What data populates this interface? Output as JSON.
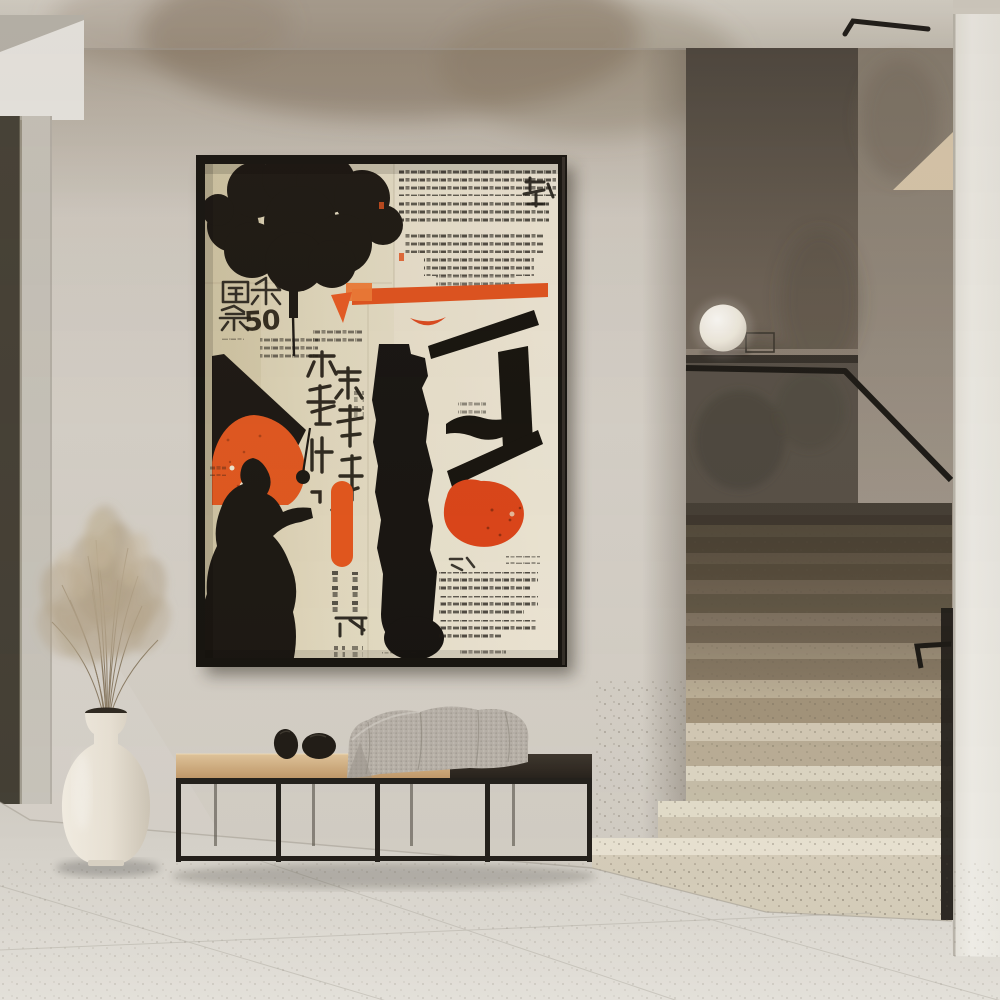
{
  "poster": {
    "number_label": "50"
  },
  "colors": {
    "ink": "#1b1712",
    "paper": "#e3dac0",
    "paper_dark": "#d3c7a5",
    "paper_light": "#ece5d3",
    "orange": "#e2521d",
    "orange_bright": "#ef7a35",
    "frame": "#15130f",
    "wall": "#d5d0c8",
    "wall_stain": "#7d6c5a",
    "ceiling": "#cbc5bb",
    "bulkhead": "#ebe9e4",
    "door_frame": "#443f35",
    "door_glass": "#c8c4bb",
    "stair_wall": "#5f574d",
    "stair_return_wall": "#978c7f",
    "step_lit": "#e2dccf",
    "step_shadow": "#7b6e5d",
    "handrail": "#1b1915",
    "lamp": "#f6f3ec",
    "column": "#ebe9e2",
    "floor": "#d9d5cd",
    "wood_light": "#d2b286",
    "wood_dark": "#362e26",
    "metal": "#23201b",
    "blanket": "#b7b1a8",
    "vase": "#ece6da",
    "pampas": "#b4a489"
  }
}
